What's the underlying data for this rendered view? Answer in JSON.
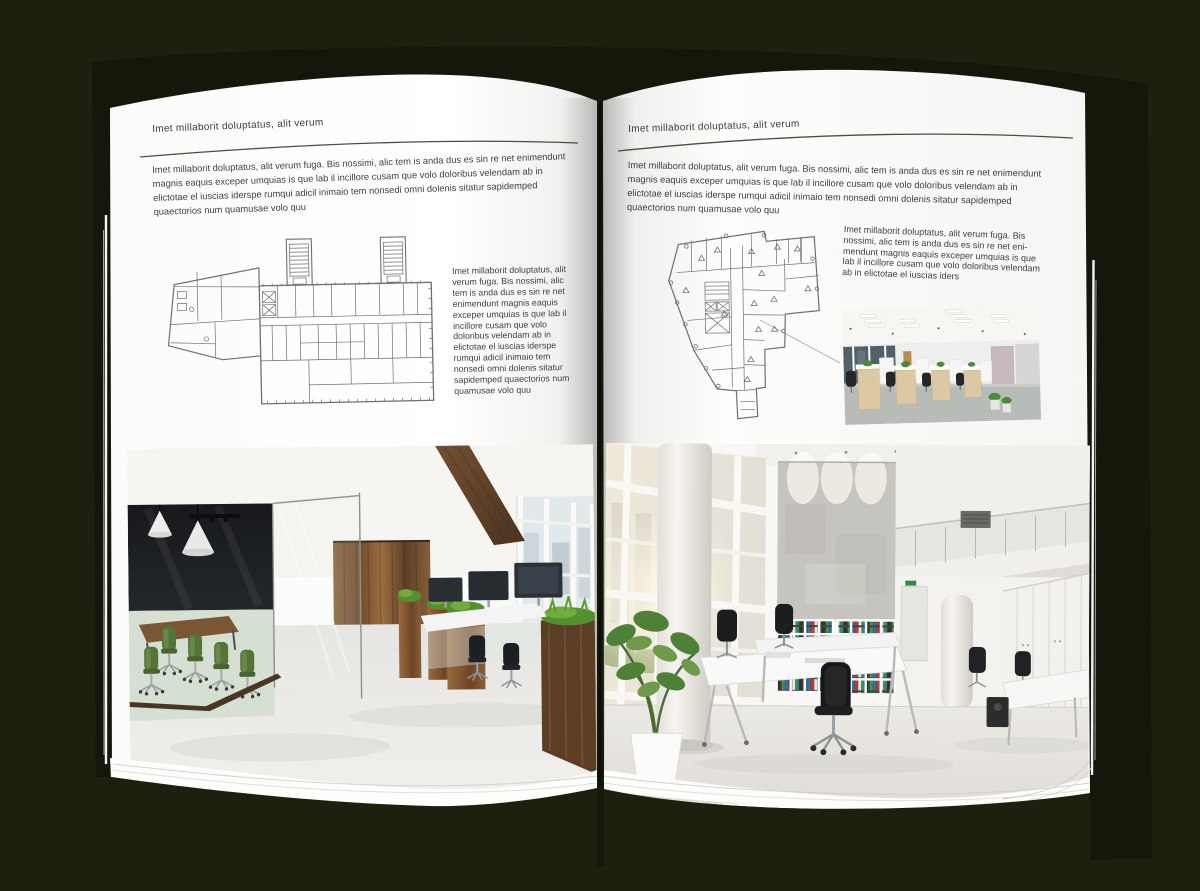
{
  "background_color": "#1e200f",
  "page_color": "#ffffff",
  "text_color": "#403e3b",
  "accent_wood": "#7a5433",
  "accent_green": "#55743a",
  "left_page": {
    "header": "Imet millaborit doluptatus, alit verum",
    "intro": "Imet millaborit doluptatus, alit verum fuga. Bis nossimi, alic tem is anda dus es sin re net enimendunt magnis eaquis exceper umquias is que lab il incillore cusam que volo doloribus velendam ab in elictotae el iuscias iderspe rumqui adicil inimaio tem nonsedi omni dolenis sitatur sapidemped quaectorios num quamusae volo quu",
    "caption": "Imet millaborit doluptatus, alit verum fuga. Bis nossimi, alic tem is anda dus es sin re net enimendunt magnis eaquis exceper umquias is que lab il incillore cusam que volo doloribus velendam ab in elictotae el iuscias iderspe rumqui adicil inimaio tem nonsedi omni dolenis sitatur sapidemped quaectorios num quamusae volo quu"
  },
  "right_page": {
    "header": "Imet millaborit doluptatus, alit verum",
    "intro": "Imet millaborit doluptatus, alit verum fuga. Bis nossimi, alic tem is anda dus es sin re net enimendunt magnis eaquis exceper umquias is que lab il incillore cusam que volo doloribus velendam ab in elictotae el iuscias iderspe rumqui adicil inimaio tem nonsedi omni dolenis sitatur sapidemped quaectorios num quamusae volo quu",
    "caption": "Imet millaborit doluptatus, alit verum fuga. Bis nossimi, alic tem is anda dus es sin re net eni-mendunt magnis eaquis exceper umquias is que lab il incillore cusam que volo doloribus velendam ab in elictotae el iuscias iders"
  }
}
